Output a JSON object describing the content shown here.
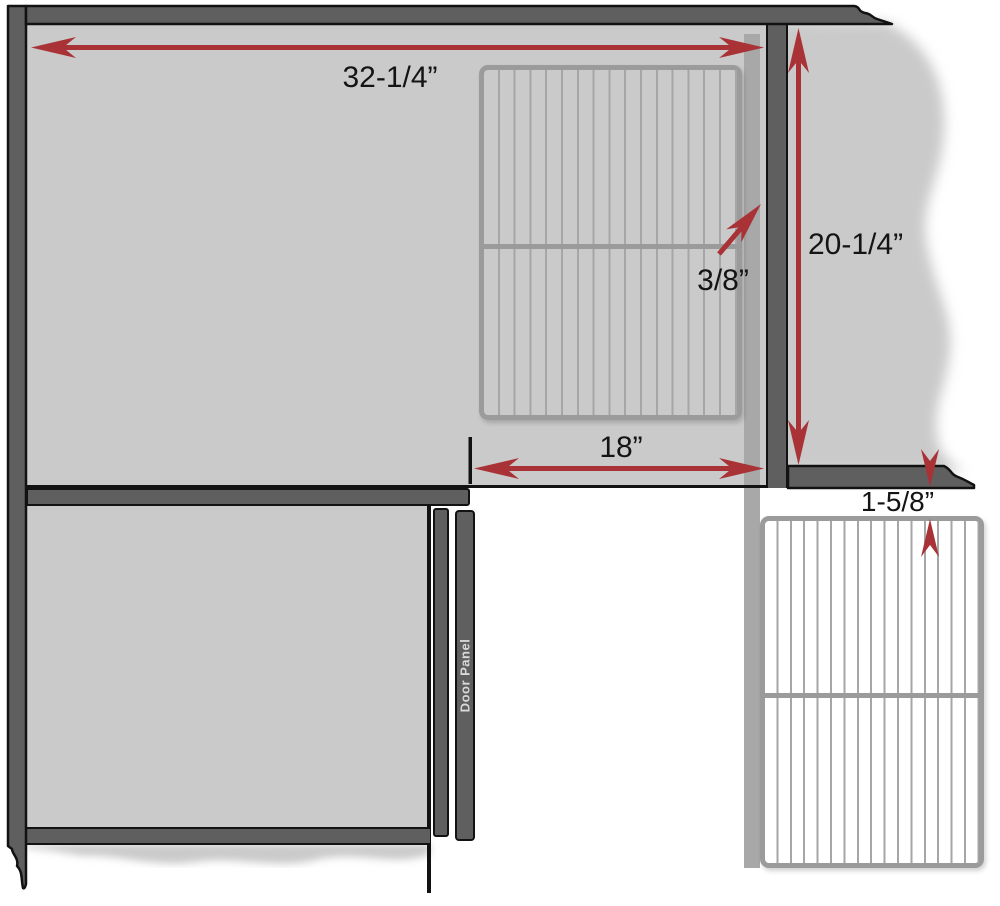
{
  "diagram": {
    "labels": {
      "width_top": "32-1/4”",
      "height_right": "20-1/4”",
      "gap_divider": "3/8”",
      "width_grille": "18”",
      "gap_bottom": "1-5/8”",
      "door_panel": "Door Panel"
    },
    "colors": {
      "wall_gray": "#cacaca",
      "frame_gray": "#5f5f5f",
      "filler_gray": "#a8a8a8",
      "grille_border": "#9b9b9b",
      "grille_line": "#a6a6a6",
      "dimension_red": "#a93237",
      "outline_black": "#121212"
    }
  }
}
